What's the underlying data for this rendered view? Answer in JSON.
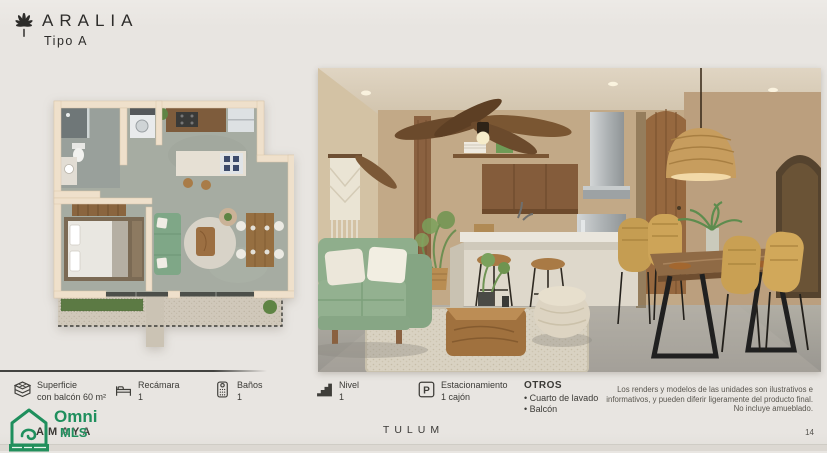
{
  "header": {
    "brand": "ARALIA",
    "subtitle": "Tipo A"
  },
  "icons": {
    "parking_glyph": "P"
  },
  "specs": [
    {
      "label": "Superficie",
      "value": "con balcón 60 m²"
    },
    {
      "label": "Recámara",
      "value": "1"
    },
    {
      "label": "Baños",
      "value": "1"
    },
    {
      "label": "Nivel",
      "value": "1"
    },
    {
      "label": "Estacionamiento",
      "value": "1 cajón"
    }
  ],
  "otros": {
    "title": "OTROS",
    "items": [
      "Cuarto de lavado",
      "Balcón"
    ]
  },
  "disclaimer": {
    "lines": [
      "Los renders y modelos de las unidades son ilustrativos e",
      "informativos, y pueden diferir ligeramente del producto final.",
      "No incluye amueblado."
    ]
  },
  "footer": {
    "location": "TULUM",
    "page_number": "14"
  },
  "watermark": {
    "overlapped_text": "AMAYA",
    "logo_primary": "Omni",
    "logo_secondary": "MLS"
  },
  "colors": {
    "background": "#e9e6e2",
    "text": "#3a3936",
    "accent_green": "#1f8f5d",
    "sofa_green": "#8aab88",
    "wood": "#8a6140",
    "plan_floor": "#a6aca2"
  }
}
